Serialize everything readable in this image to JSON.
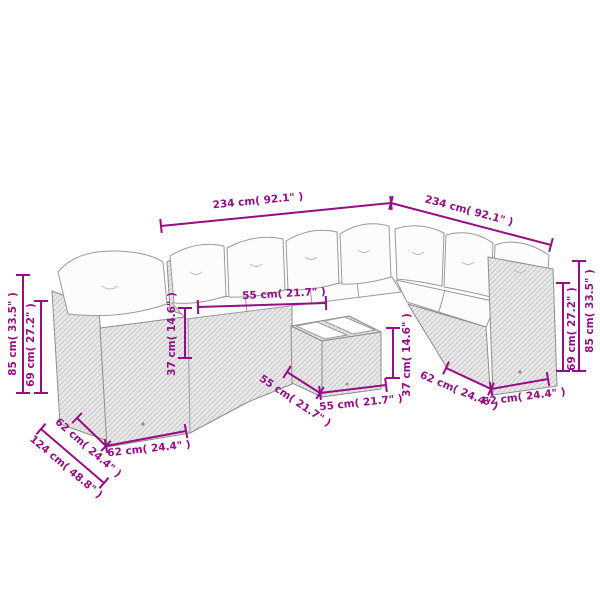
{
  "diagram": {
    "type": "furniture-dimension-diagram",
    "canvas": {
      "width": 600,
      "height": 600,
      "background": "#ffffff"
    },
    "colors": {
      "dimension": "#970d87",
      "line_art": "#8d8d8d",
      "wicker_fill": "#ececec",
      "cushion_fill": "#fcfcfc"
    },
    "units": [
      "cm",
      "inch"
    ],
    "dimensions": [
      {
        "name": "back-width-left",
        "label": "234 cm( 92.1\" )",
        "value_cm": 234,
        "value_in": 92.1,
        "x1": 161,
        "y1": 226,
        "x2": 391,
        "y2": 203,
        "lx": 258,
        "ly": 201,
        "angle": -5.5
      },
      {
        "name": "back-width-right",
        "label": "234 cm( 92.1\" )",
        "value_cm": 234,
        "value_in": 92.1,
        "x1": 391,
        "y1": 203,
        "x2": 551,
        "y2": 245,
        "lx": 469,
        "ly": 211,
        "angle": 15
      },
      {
        "name": "total-height-left",
        "label": "85 cm( 33.5\" )",
        "value_cm": 85,
        "value_in": 33.5,
        "x1": 23,
        "y1": 275,
        "x2": 23,
        "y2": 393,
        "lx": 13,
        "ly": 334,
        "angle": -90
      },
      {
        "name": "back-height-left",
        "label": "69 cm( 27.2\" )",
        "value_cm": 69,
        "value_in": 27.2,
        "x1": 41,
        "y1": 301,
        "x2": 41,
        "y2": 393,
        "lx": 31,
        "ly": 345,
        "angle": -90
      },
      {
        "name": "seat-width-middle",
        "label": "55 cm( 21.7\" )",
        "value_cm": 55,
        "value_in": 21.7,
        "x1": 198,
        "y1": 307,
        "x2": 326,
        "y2": 303,
        "lx": 284,
        "ly": 294,
        "angle": -3
      },
      {
        "name": "seat-height-left",
        "label": "37 cm( 14.6\" )",
        "value_cm": 37,
        "value_in": 14.6,
        "x1": 185,
        "y1": 308,
        "x2": 185,
        "y2": 358,
        "lx": 172,
        "ly": 334,
        "angle": -90
      },
      {
        "name": "table-height-right",
        "label": "37 cm( 14.6\" )",
        "value_cm": 37,
        "value_in": 14.6,
        "x1": 393,
        "y1": 328,
        "x2": 393,
        "y2": 378,
        "lx": 407,
        "ly": 355,
        "angle": -90
      },
      {
        "name": "table-depth-left",
        "label": "55 cm( 21.7\" )",
        "value_cm": 55,
        "value_in": 21.7,
        "x1": 287,
        "y1": 372,
        "x2": 320,
        "y2": 393,
        "lx": 295,
        "ly": 401,
        "angle": 34
      },
      {
        "name": "table-width-front",
        "label": "55 cm( 21.7\" )",
        "value_cm": 55,
        "value_in": 21.7,
        "x1": 320,
        "y1": 393,
        "x2": 386,
        "y2": 385,
        "lx": 361,
        "ly": 403,
        "angle": -6
      },
      {
        "name": "module-depth-left",
        "label": "62 cm( 24.4\" )",
        "value_cm": 62,
        "value_in": 24.4,
        "x1": 77,
        "y1": 418,
        "x2": 106,
        "y2": 446,
        "lx": 88,
        "ly": 448,
        "angle": 41
      },
      {
        "name": "module-width-left",
        "label": "62 cm( 24.4\" )",
        "value_cm": 62,
        "value_in": 24.4,
        "x1": 106,
        "y1": 446,
        "x2": 186,
        "y2": 431,
        "lx": 149,
        "ly": 449,
        "angle": -6
      },
      {
        "name": "corner-depth-left",
        "label": "124 cm( 48.8\" )",
        "value_cm": 124,
        "value_in": 48.8,
        "x1": 41,
        "y1": 429,
        "x2": 104,
        "y2": 483,
        "lx": 66,
        "ly": 467,
        "angle": 40
      },
      {
        "name": "module-depth-right",
        "label": "62 cm( 24.4\" )",
        "value_cm": 62,
        "value_in": 24.4,
        "x1": 446,
        "y1": 368,
        "x2": 491,
        "y2": 389,
        "lx": 459,
        "ly": 391,
        "angle": 23
      },
      {
        "name": "module-width-right",
        "label": "62 cm( 24.4\" )",
        "value_cm": 62,
        "value_in": 24.4,
        "x1": 491,
        "y1": 389,
        "x2": 548,
        "y2": 379,
        "lx": 524,
        "ly": 397,
        "angle": -7
      },
      {
        "name": "back-height-right",
        "label": "69 cm( 27.2\" )",
        "value_cm": 69,
        "value_in": 27.2,
        "x1": 563,
        "y1": 283,
        "x2": 563,
        "y2": 371,
        "lx": 572,
        "ly": 329,
        "angle": -90
      },
      {
        "name": "total-height-right",
        "label": "85 cm( 33.5\" )",
        "value_cm": 85,
        "value_in": 33.5,
        "x1": 579,
        "y1": 261,
        "x2": 579,
        "y2": 371,
        "lx": 590,
        "ly": 311,
        "angle": -90
      }
    ]
  }
}
